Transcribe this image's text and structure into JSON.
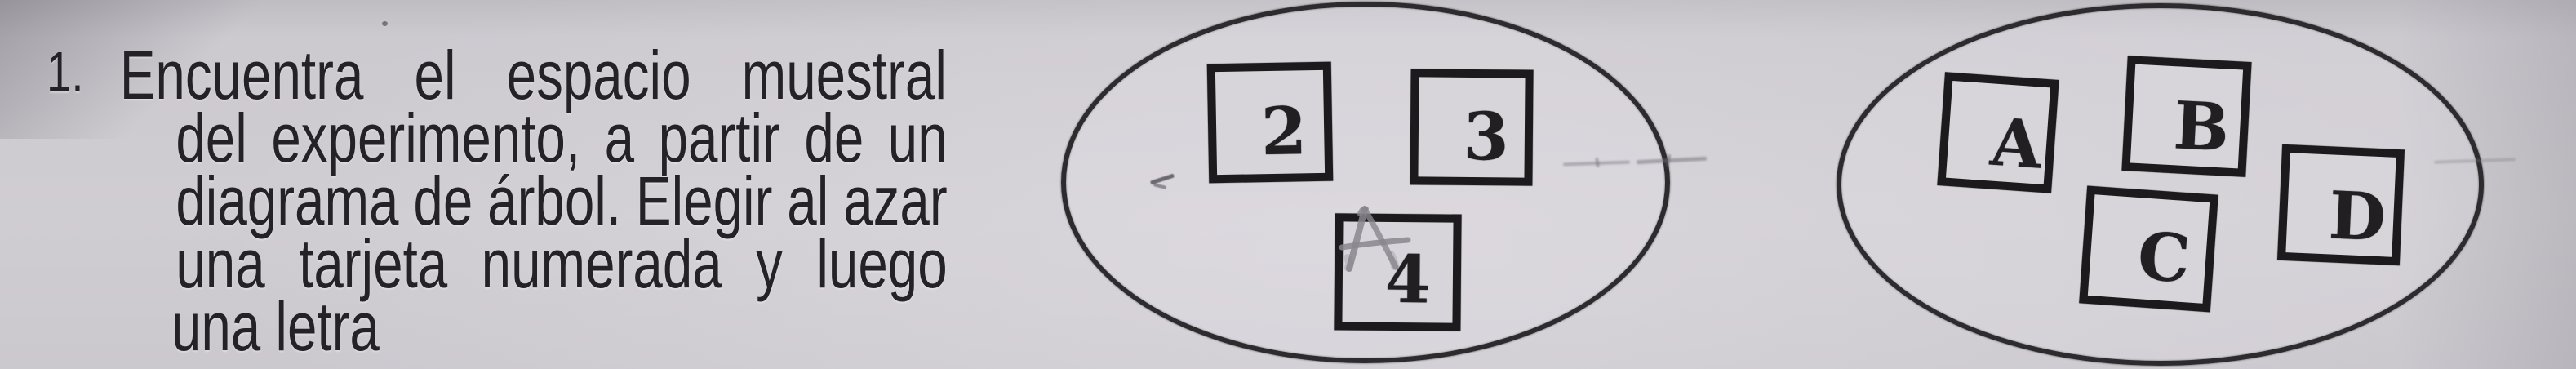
{
  "colors": {
    "paper": "#cfccd2",
    "ink": "#242127",
    "card_border": "#1c1a1d",
    "pencil": "#8a868d"
  },
  "problem": {
    "number": "1.",
    "lines": [
      {
        "text": "Encuentra el espacio muestral",
        "justify": true
      },
      {
        "text": "del experimento, a partir de un",
        "justify": true
      },
      {
        "text": "diagrama de árbol. Elegir al azar",
        "justify": true
      },
      {
        "text": "una tarjeta numerada y luego",
        "justify": true
      },
      {
        "text": "una letra",
        "justify": false
      }
    ],
    "full_text": "1. Encuentra el espacio muestral del experimento, a partir de un diagrama de árbol. Elegir al azar una tarjeta numerada y luego una letra"
  },
  "diagram": {
    "number_cards": [
      "2",
      "3",
      "4"
    ],
    "letter_cards": [
      "A",
      "B",
      "C",
      "D"
    ],
    "pencil_annotation": "A"
  }
}
